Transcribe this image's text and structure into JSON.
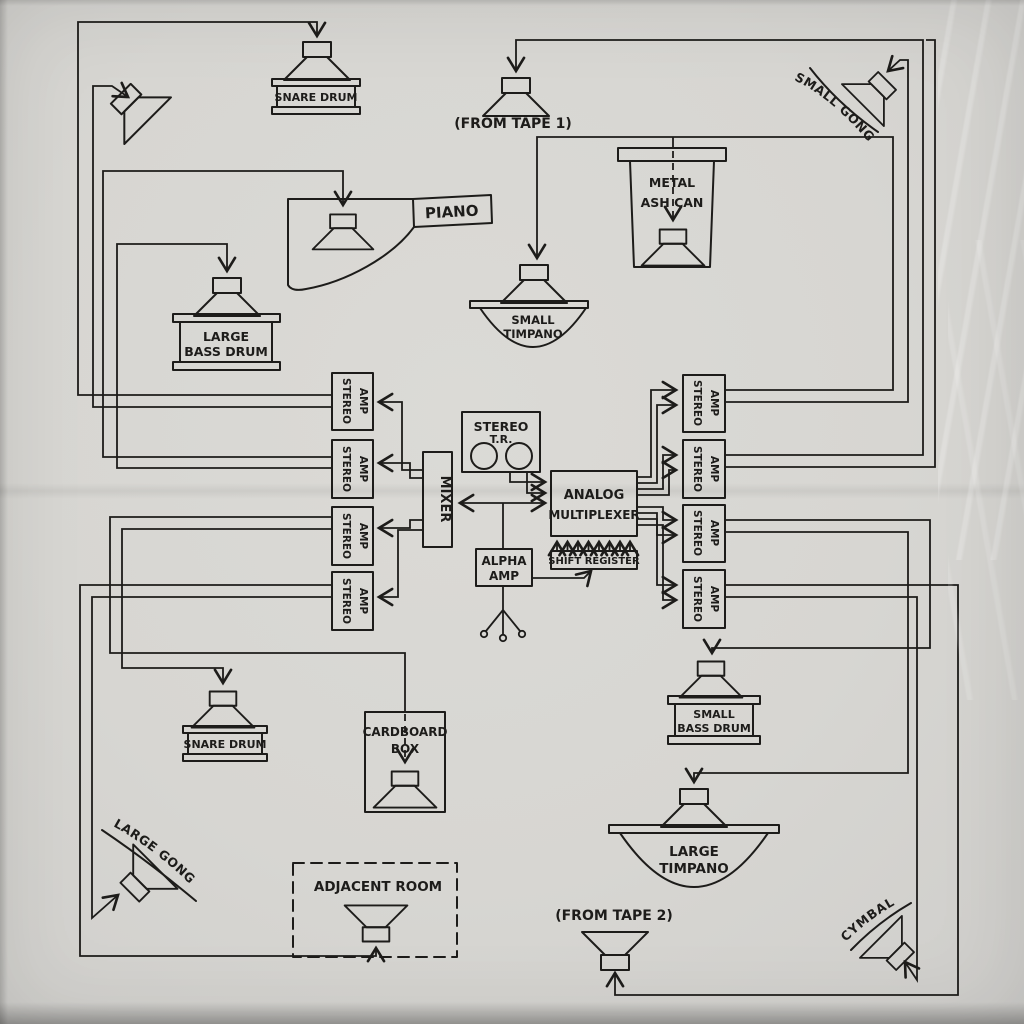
{
  "colors": {
    "paper": "#d7d6d2",
    "ink": "#1d1c1a"
  },
  "sources": {
    "from_tape_1": "(FROM TAPE 1)",
    "from_tape_2": "(FROM TAPE 2)"
  },
  "rooms": {
    "adjacent_room": "ADJACENT ROOM"
  },
  "instruments": {
    "snare_drum_top": "SNARE DRUM",
    "piano": "PIANO",
    "metal_ash_can": {
      "line1": "METAL",
      "line2": "ASH CAN"
    },
    "small_gong": "SMALL GONG",
    "small_timpano": {
      "line1": "SMALL",
      "line2": "TIMPANO"
    },
    "large_bass_drum": {
      "line1": "LARGE",
      "line2": "BASS DRUM"
    },
    "snare_drum_bottom": "SNARE DRUM",
    "cardboard_box": {
      "line1": "CARDBOARD",
      "line2": "BOX"
    },
    "large_gong": "LARGE GONG",
    "small_bass_drum": {
      "line1": "SMALL",
      "line2": "BASS DRUM"
    },
    "large_timpano": {
      "line1": "LARGE",
      "line2": "TIMPANO"
    },
    "cymbal": "CYMBAL"
  },
  "electronics": {
    "stereo_amp": {
      "line1": "STEREO",
      "line2": "AMP"
    },
    "mixer": "MIXER",
    "stereo_tape_recorder": {
      "line1": "STEREO",
      "line2": "T.R."
    },
    "analog_multiplexer": {
      "line1": "ANALOG",
      "line2": "MULTIPLEXER"
    },
    "shift_register": "SHIFT REGISTER",
    "alpha_amp": {
      "line1": "ALPHA",
      "line2": "AMP"
    }
  }
}
